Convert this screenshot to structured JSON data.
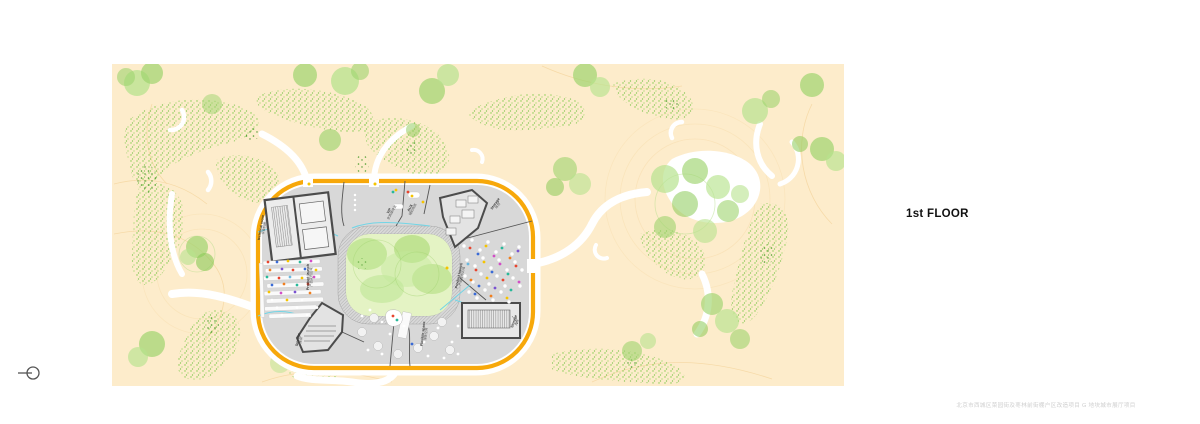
{
  "page": {
    "floor_label": "1st FLOOR",
    "caption": "北京市西城区菜园街及枣林前街棚户区改造项目 G 地块城市展厅项目"
  },
  "plan": {
    "rooms": [
      {
        "id": "technical-room",
        "en": "technical room",
        "zh": "设备机房"
      },
      {
        "id": "vip",
        "en": "VIP",
        "zh": "贵宾接待室"
      },
      {
        "id": "aux",
        "en": "AUX",
        "zh": "辅助用房"
      },
      {
        "id": "storage-ne",
        "en": "Storage",
        "zh": "库房"
      },
      {
        "id": "product-launch-left",
        "en": "Product launch",
        "zh": "产品发布区域"
      },
      {
        "id": "product-launch-right",
        "en": "Product launch",
        "zh": "产品发布区域"
      },
      {
        "id": "storage-sw",
        "en": "Storage",
        "zh": "库房"
      },
      {
        "id": "flexible-space",
        "en": "Flexible space",
        "zh": "弹性空间"
      },
      {
        "id": "storage-se",
        "en": "Storage",
        "zh": "库房"
      }
    ],
    "colors": {
      "site_background": "#fdeccb",
      "building_outline": "#f7a80a",
      "floor_gray": "#d8d8d8",
      "courtyard_green": "#e4f3c4",
      "tree_green": "#9ed46e",
      "glass_partition": "#72d5e6",
      "contour_line": "#f5d6a0"
    }
  }
}
